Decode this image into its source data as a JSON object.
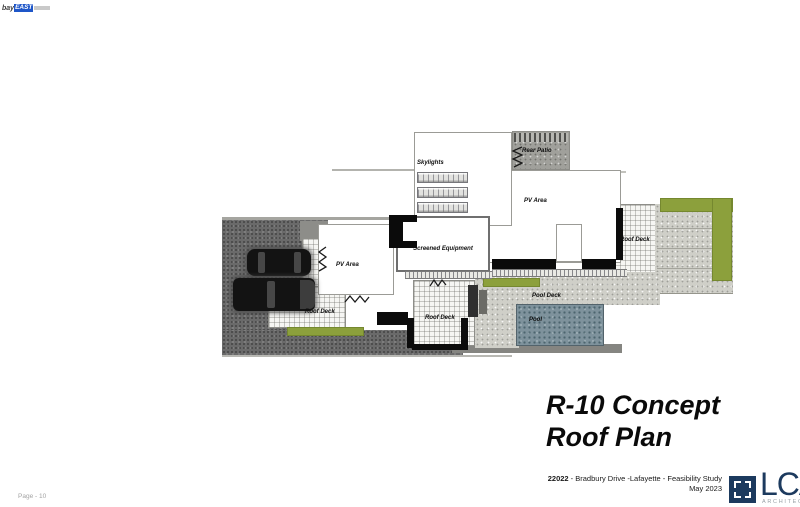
{
  "watermark": {
    "prefix": "bay",
    "badge": "EAST"
  },
  "plan": {
    "labels": {
      "skylights": "Skylights",
      "rear_patio": "Rear Patio",
      "pv_area_upper": "PV Area",
      "pv_area_lower": "PV Area",
      "screened_equipment": "Screened Equipment",
      "roof_deck_right": "Roof Deck",
      "roof_deck_left": "Roof Deck",
      "roof_deck_center": "Roof Deck",
      "pool_deck": "Pool Deck",
      "pool": "Pool"
    }
  },
  "title": {
    "line1": "R-10 Concept",
    "line2": "Roof Plan"
  },
  "titleblock": {
    "project_number": "22022",
    "project_text": " - Bradbury Drive -Lafayette - Feasibility Study",
    "date": "May 2023",
    "logo_acronym": "LCA",
    "logo_subtitle": "ARCHITECTS"
  },
  "footer": {
    "page_label": "Page - 10"
  },
  "colors": {
    "planter_green": "#8ca03c",
    "pool_blue": "#7e929c",
    "asphalt_gray": "#6a6a6a",
    "concrete_gray": "#cfcfc8",
    "rear_patio_gray": "#a0a09b",
    "logo_navy": "#1c3a5e",
    "watermark_blue": "#1e56c8"
  }
}
